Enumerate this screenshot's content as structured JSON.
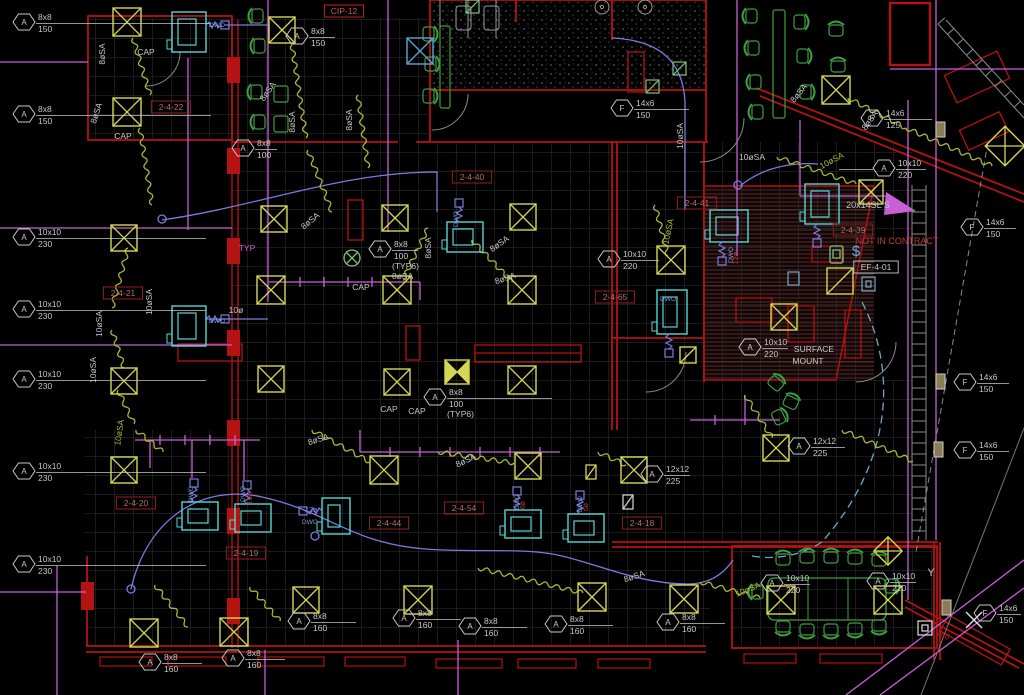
{
  "colors": {
    "wall_red": "#b51212",
    "dark_red": "#7a0d0d",
    "grid_gray": "#343434",
    "text_gray": "#c8c8c8",
    "diffuser_yellow": "#d6d655",
    "flex_olive": "#a8b832",
    "equip_cyan": "#55d6d6",
    "duct_blue": "#7b7bde",
    "main_magenta": "#c85fd7",
    "furniture_green": "#3f9e3f",
    "tag_maroon": "#bd6868",
    "nic_red": "#c03a3a"
  },
  "duct_tags": [
    {
      "letter": "A",
      "size": "8x8",
      "flow": "150",
      "x": 24,
      "y": 22,
      "lead": 175
    },
    {
      "letter": "A",
      "size": "8x8",
      "flow": "150",
      "x": 24,
      "y": 114,
      "lead": 175
    },
    {
      "letter": "A",
      "size": "8x8",
      "flow": "150",
      "x": 297,
      "y": 36,
      "lead": 26
    },
    {
      "letter": "A",
      "size": "8x8",
      "flow": "100",
      "x": 243,
      "y": 148,
      "lead": 22
    },
    {
      "letter": "A",
      "size": "8x8",
      "flow": "100",
      "x": 380,
      "y": 249,
      "lead": 26,
      "extra": [
        "(TYP6)",
        "8øSA"
      ]
    },
    {
      "letter": "A",
      "size": "8x8",
      "flow": "100",
      "x": 435,
      "y": 397,
      "lead": 105,
      "extra": [
        "(TYP6)"
      ]
    },
    {
      "letter": "F",
      "size": "14x6",
      "flow": "150",
      "x": 622,
      "y": 108,
      "lead": 55
    },
    {
      "letter": "F",
      "size": "14x6",
      "flow": "125",
      "x": 872,
      "y": 118,
      "lead": 48
    },
    {
      "letter": "A",
      "size": "10x10",
      "flow": "220",
      "x": 884,
      "y": 168,
      "lead": 30,
      "lead_left": 34
    },
    {
      "letter": "A",
      "size": "10x10",
      "flow": "230",
      "x": 24,
      "y": 237,
      "lead": 170
    },
    {
      "letter": "A",
      "size": "10x10",
      "flow": "230",
      "x": 24,
      "y": 309,
      "lead": 170
    },
    {
      "letter": "A",
      "size": "10x10",
      "flow": "230",
      "x": 24,
      "y": 379,
      "lead": 170
    },
    {
      "letter": "A",
      "size": "10x10",
      "flow": "230",
      "x": 24,
      "y": 471,
      "lead": 170
    },
    {
      "letter": "A",
      "size": "10x10",
      "flow": "230",
      "x": 24,
      "y": 564,
      "lead": 170
    },
    {
      "letter": "A",
      "size": "10x10",
      "flow": "220",
      "x": 609,
      "y": 259,
      "lead": 38
    },
    {
      "letter": "A",
      "size": "10x10",
      "flow": "220",
      "x": 750,
      "y": 347,
      "lead": 26
    },
    {
      "letter": "A",
      "size": "12x12",
      "flow": "225",
      "x": 652,
      "y": 474,
      "lead": 26
    },
    {
      "letter": "A",
      "size": "12x12",
      "flow": "225",
      "x": 799,
      "y": 446,
      "lead": 34
    },
    {
      "letter": "A",
      "size": "10x10",
      "flow": "220",
      "x": 772,
      "y": 583,
      "lead": 26
    },
    {
      "letter": "A",
      "size": "10x10",
      "flow": "220",
      "x": 878,
      "y": 581,
      "lead": 26
    },
    {
      "letter": "F",
      "size": "14x6",
      "flow": "150",
      "x": 972,
      "y": 227,
      "lead": 32
    },
    {
      "letter": "F",
      "size": "14x6",
      "flow": "150",
      "x": 965,
      "y": 382,
      "lead": 32
    },
    {
      "letter": "F",
      "size": "14x6",
      "flow": "150",
      "x": 965,
      "y": 450,
      "lead": 32
    },
    {
      "letter": "F",
      "size": "14x6",
      "flow": "150",
      "x": 985,
      "y": 613,
      "lead": 24
    },
    {
      "letter": "A",
      "size": "8x8",
      "flow": "160",
      "x": 150,
      "y": 662,
      "lead": 40
    },
    {
      "letter": "A",
      "size": "8x8",
      "flow": "160",
      "x": 233,
      "y": 658,
      "lead": 40
    },
    {
      "letter": "A",
      "size": "8x8",
      "flow": "160",
      "x": 299,
      "y": 621,
      "lead": 45
    },
    {
      "letter": "A",
      "size": "8x8",
      "flow": "160",
      "x": 404,
      "y": 618,
      "lead": 45
    },
    {
      "letter": "A",
      "size": "8x8",
      "flow": "160",
      "x": 470,
      "y": 626,
      "lead": 45
    },
    {
      "letter": "A",
      "size": "8x8",
      "flow": "160",
      "x": 556,
      "y": 624,
      "lead": 45
    },
    {
      "letter": "A",
      "size": "8x8",
      "flow": "160",
      "x": 668,
      "y": 622,
      "lead": 45
    }
  ],
  "ref_tags": [
    {
      "text": "CIP-12",
      "x": 344,
      "y": 11,
      "style": "bright"
    },
    {
      "text": "2-4-22",
      "x": 171,
      "y": 107,
      "style": "red"
    },
    {
      "text": "2-4-40",
      "x": 472,
      "y": 177,
      "style": "red"
    },
    {
      "text": "2-4-41",
      "x": 697,
      "y": 203,
      "style": "red"
    },
    {
      "text": "2-4-39",
      "x": 853,
      "y": 230,
      "style": "red"
    },
    {
      "text": "2-4-65",
      "x": 615,
      "y": 297,
      "style": "red"
    },
    {
      "text": "2-4-21",
      "x": 123,
      "y": 293,
      "style": "red"
    },
    {
      "text": "2-4-20",
      "x": 136,
      "y": 503,
      "style": "red"
    },
    {
      "text": "2-4-19",
      "x": 246,
      "y": 553,
      "style": "red"
    },
    {
      "text": "2-4-44",
      "x": 389,
      "y": 523,
      "style": "red"
    },
    {
      "text": "2-4-54",
      "x": 464,
      "y": 508,
      "style": "red"
    },
    {
      "text": "2-4-18",
      "x": 642,
      "y": 523,
      "style": "red"
    },
    {
      "text": "EF-4-01",
      "x": 876,
      "y": 267,
      "style": "white"
    }
  ],
  "labels": [
    {
      "text": "CAP",
      "x": 146,
      "y": 55
    },
    {
      "text": "CAP",
      "x": 123,
      "y": 139
    },
    {
      "text": "CAP",
      "x": 361,
      "y": 290
    },
    {
      "text": "CAP",
      "x": 389,
      "y": 412
    },
    {
      "text": "CAP",
      "x": 417,
      "y": 414
    },
    {
      "text": "TYP",
      "x": 247,
      "y": 251,
      "color": "#c85fd7"
    },
    {
      "text": "SURFACE",
      "x": 814,
      "y": 352
    },
    {
      "text": "MOUNT",
      "x": 808,
      "y": 364
    },
    {
      "text": "NOT IN CONTRACT",
      "x": 897,
      "y": 244,
      "color": "#c03a3a",
      "size": 9
    },
    {
      "text": "20x14SL S",
      "x": 868,
      "y": 208,
      "size": 9
    },
    {
      "text": "Y",
      "x": 931,
      "y": 576,
      "size": 11
    },
    {
      "text": "280",
      "x": 942,
      "y": 637,
      "color": "#bb2222",
      "rot": 28,
      "size": 8
    },
    {
      "text": "$",
      "x": 856,
      "y": 256,
      "color": "#6fa8dd",
      "size": 15
    },
    {
      "text": "10øSA",
      "x": 752,
      "y": 160
    },
    {
      "text": "10øSA",
      "x": 833,
      "y": 163,
      "rot": -28,
      "color": "#a8b832"
    },
    {
      "text": "10øSA",
      "x": 683,
      "y": 136,
      "rot": -90
    },
    {
      "text": "10øSA",
      "x": 671,
      "y": 232,
      "rot": -78,
      "color": "#a8b832"
    },
    {
      "text": "8øSA",
      "x": 105,
      "y": 54,
      "rot": -90
    },
    {
      "text": "8øSA",
      "x": 99,
      "y": 114,
      "rot": -72
    },
    {
      "text": "8øSA",
      "x": 270,
      "y": 93,
      "rot": -55
    },
    {
      "text": "8øSA",
      "x": 295,
      "y": 122,
      "rot": -90
    },
    {
      "text": "8øSA",
      "x": 352,
      "y": 120,
      "rot": -90
    },
    {
      "text": "8øSA",
      "x": 431,
      "y": 248,
      "rot": -90
    },
    {
      "text": "8øSA",
      "x": 312,
      "y": 223,
      "rot": -40
    },
    {
      "text": "8øSA",
      "x": 501,
      "y": 246,
      "rot": -35
    },
    {
      "text": "8øSA",
      "x": 506,
      "y": 281,
      "rot": -18
    },
    {
      "text": "10øSA",
      "x": 152,
      "y": 302,
      "rot": -90
    },
    {
      "text": "10øSA",
      "x": 102,
      "y": 324,
      "rot": -90
    },
    {
      "text": "10øSA",
      "x": 96,
      "y": 370,
      "rot": -90
    },
    {
      "text": "10øSA",
      "x": 122,
      "y": 433,
      "rot": -82,
      "color": "#a8b832"
    },
    {
      "text": "8øSA",
      "x": 872,
      "y": 122,
      "rot": -55
    },
    {
      "text": "8øSA",
      "x": 801,
      "y": 95,
      "rot": -50
    },
    {
      "text": "8øSA",
      "x": 319,
      "y": 442,
      "rot": -18
    },
    {
      "text": "8øSA",
      "x": 467,
      "y": 463,
      "rot": -25
    },
    {
      "text": "8øSA",
      "x": 635,
      "y": 579,
      "rot": -18
    },
    {
      "text": "10øSA",
      "x": 749,
      "y": 592,
      "rot": -22,
      "color": "#a8b832"
    },
    {
      "text": "10ø",
      "x": 236,
      "y": 313
    },
    {
      "text": "10ø",
      "x": 252,
      "y": 498,
      "rot": -90,
      "color": "#bb3333",
      "size": 7.5
    },
    {
      "text": "12ø",
      "x": 738,
      "y": 258,
      "rot": -90,
      "color": "#bb3333",
      "size": 7.5
    },
    {
      "text": "12ø",
      "x": 311,
      "y": 512,
      "color": "#7b7bde",
      "size": 7.5
    },
    {
      "text": "6ø",
      "x": 525,
      "y": 505,
      "rot": -90,
      "color": "#bb3333",
      "size": 7
    },
    {
      "text": "6ø",
      "x": 588,
      "y": 507,
      "rot": -90,
      "color": "#bb3333",
      "size": 7
    },
    {
      "text": "DWO",
      "x": 217,
      "y": 27,
      "color": "#7b9bde",
      "size": 6.5
    },
    {
      "text": "DWO",
      "x": 217,
      "y": 323,
      "color": "#7b9bde",
      "size": 6.5
    },
    {
      "text": "DWO",
      "x": 458,
      "y": 219,
      "rot": -90,
      "color": "#7b9bde",
      "size": 6.5
    },
    {
      "text": "DWO",
      "x": 733,
      "y": 255,
      "rot": -90,
      "color": "#7b9bde",
      "size": 6.5
    },
    {
      "text": "DWO",
      "x": 668,
      "y": 301,
      "color": "#7b9bde",
      "size": 6.5
    },
    {
      "text": "DWO",
      "x": 193,
      "y": 494,
      "rot": -90,
      "color": "#7b9bde",
      "size": 6.5
    },
    {
      "text": "DWO",
      "x": 245,
      "y": 494,
      "rot": -90,
      "color": "#7b9bde",
      "size": 6.5
    },
    {
      "text": "DWO",
      "x": 310,
      "y": 524,
      "color": "#7b9bde",
      "size": 6.5
    },
    {
      "text": "DWO",
      "x": 519,
      "y": 502,
      "rot": -90,
      "color": "#7b9bde",
      "size": 6.5
    },
    {
      "text": "DWO",
      "x": 582,
      "y": 504,
      "rot": -90,
      "color": "#7b9bde",
      "size": 6.5
    }
  ],
  "symbols": {
    "diffusers": [
      [
        127,
        22,
        28,
        "x"
      ],
      [
        127,
        112,
        28,
        "x"
      ],
      [
        282,
        30,
        26,
        "x"
      ],
      [
        420,
        51,
        26,
        "cx"
      ],
      [
        836,
        90,
        28,
        "x"
      ],
      [
        1005,
        146,
        28,
        "xr"
      ],
      [
        871,
        192,
        24,
        "x"
      ],
      [
        274,
        219,
        26,
        "x"
      ],
      [
        395,
        218,
        26,
        "x"
      ],
      [
        523,
        217,
        26,
        "x"
      ],
      [
        124,
        238,
        26,
        "x"
      ],
      [
        271,
        290,
        28,
        "x"
      ],
      [
        397,
        290,
        28,
        "x"
      ],
      [
        522,
        290,
        28,
        "x"
      ],
      [
        124,
        381,
        26,
        "x"
      ],
      [
        271,
        379,
        26,
        "x"
      ],
      [
        397,
        382,
        26,
        "x"
      ],
      [
        522,
        380,
        28,
        "x"
      ],
      [
        457,
        372,
        24,
        "bt"
      ],
      [
        671,
        260,
        28,
        "x"
      ],
      [
        784,
        317,
        26,
        "x"
      ],
      [
        840,
        281,
        26,
        "sl"
      ],
      [
        688,
        355,
        16,
        "sl"
      ],
      [
        124,
        470,
        26,
        "x"
      ],
      [
        384,
        470,
        28,
        "x"
      ],
      [
        528,
        466,
        26,
        "x"
      ],
      [
        634,
        470,
        26,
        "x"
      ],
      [
        776,
        448,
        26,
        "x"
      ],
      [
        144,
        633,
        28,
        "x"
      ],
      [
        234,
        632,
        28,
        "x"
      ],
      [
        306,
        600,
        26,
        "x"
      ],
      [
        418,
        600,
        28,
        "x"
      ],
      [
        592,
        597,
        28,
        "x"
      ],
      [
        684,
        599,
        28,
        "x"
      ],
      [
        781,
        600,
        28,
        "x"
      ],
      [
        888,
        600,
        28,
        "x"
      ],
      [
        888,
        551,
        20,
        "xr"
      ],
      [
        591,
        472,
        14,
        "slv"
      ],
      [
        628,
        502,
        14,
        "slw"
      ]
    ],
    "green_fixtures": [
      [
        472,
        6
      ],
      [
        679,
        68
      ],
      [
        652,
        86
      ]
    ],
    "vav_units": [
      [
        172,
        12,
        34,
        40,
        "r"
      ],
      [
        172,
        306,
        34,
        40,
        "r"
      ],
      [
        447,
        222,
        36,
        30,
        "t"
      ],
      [
        710,
        210,
        38,
        32,
        "b"
      ],
      [
        805,
        184,
        34,
        40,
        "b"
      ],
      [
        657,
        290,
        30,
        44,
        "b"
      ],
      [
        182,
        502,
        36,
        28,
        "t"
      ],
      [
        235,
        504,
        36,
        28,
        "t"
      ],
      [
        322,
        498,
        28,
        36,
        "l"
      ],
      [
        505,
        510,
        36,
        28,
        "t"
      ],
      [
        568,
        514,
        36,
        28,
        "t"
      ]
    ],
    "flex_ducts": [
      [
        133,
        38,
        150,
        95
      ],
      [
        140,
        128,
        152,
        205
      ],
      [
        292,
        45,
        306,
        138
      ],
      [
        308,
        150,
        332,
        212
      ],
      [
        848,
        98,
        906,
        128
      ],
      [
        906,
        128,
        992,
        166
      ],
      [
        777,
        157,
        856,
        184
      ],
      [
        428,
        228,
        403,
        280
      ],
      [
        472,
        240,
        512,
        282
      ],
      [
        655,
        205,
        668,
        256
      ],
      [
        128,
        248,
        112,
        308
      ],
      [
        112,
        330,
        124,
        368
      ],
      [
        118,
        390,
        134,
        424
      ],
      [
        136,
        430,
        163,
        452
      ],
      [
        312,
        430,
        370,
        462
      ],
      [
        438,
        452,
        514,
        463
      ],
      [
        478,
        568,
        583,
        593
      ],
      [
        700,
        582,
        760,
        598
      ],
      [
        155,
        585,
        188,
        627
      ],
      [
        250,
        587,
        280,
        621
      ],
      [
        745,
        395,
        772,
        438
      ],
      [
        842,
        430,
        913,
        461
      ],
      [
        598,
        452,
        626,
        465
      ],
      [
        358,
        95,
        368,
        168
      ]
    ],
    "chairs": [
      [
        257,
        16,
        -90
      ],
      [
        259,
        46,
        -90
      ],
      [
        256,
        92,
        -90
      ],
      [
        259,
        122,
        -90
      ],
      [
        429,
        34,
        90
      ],
      [
        431,
        64,
        90
      ],
      [
        429,
        96,
        90
      ],
      [
        751,
        16,
        -90
      ],
      [
        753,
        48,
        -90
      ],
      [
        755,
        82,
        -90
      ],
      [
        757,
        112,
        -90
      ],
      [
        800,
        22,
        90
      ],
      [
        803,
        56,
        90
      ],
      [
        806,
        92,
        90
      ],
      [
        836,
        30,
        0
      ],
      [
        838,
        66,
        0
      ],
      [
        776,
        383,
        40
      ],
      [
        791,
        402,
        25
      ],
      [
        779,
        417,
        65
      ],
      [
        783,
        559,
        0
      ],
      [
        807,
        557,
        0
      ],
      [
        831,
        557,
        0
      ],
      [
        855,
        558,
        0
      ],
      [
        879,
        560,
        0
      ],
      [
        783,
        627,
        180
      ],
      [
        807,
        630,
        180
      ],
      [
        831,
        630,
        180
      ],
      [
        855,
        629,
        180
      ],
      [
        879,
        626,
        180
      ],
      [
        757,
        592,
        -90
      ],
      [
        891,
        586,
        90
      ]
    ]
  }
}
